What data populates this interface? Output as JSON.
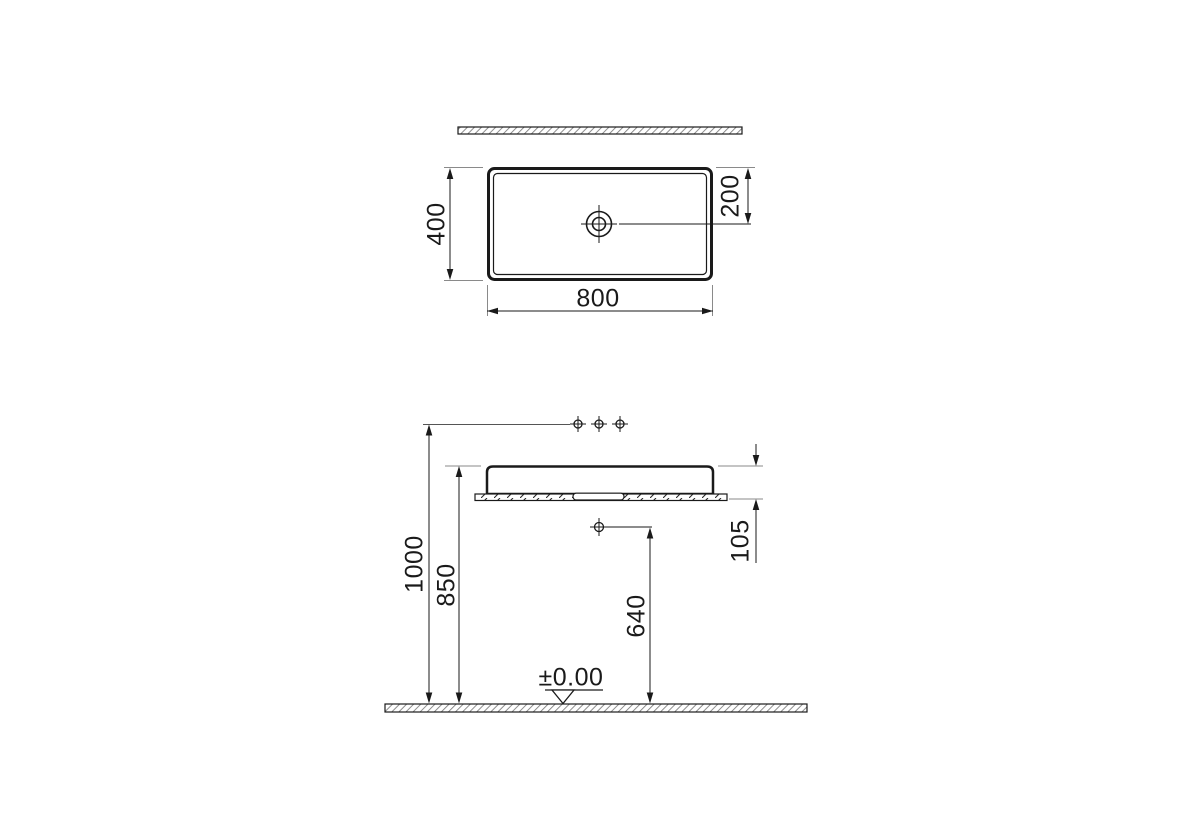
{
  "drawing": {
    "colors": {
      "line": "#1a1a1a",
      "extension_line": "#8a8a8a",
      "hatch": "#7a7a7a",
      "background": "#ffffff"
    },
    "top_view": {
      "labels": {
        "width": "800",
        "depth": "400",
        "drain_offset": "200"
      }
    },
    "front_view": {
      "labels": {
        "faucet_height": "1000",
        "rim_height": "850",
        "outlet_height": "640",
        "basin_height": "105",
        "floor_level": "±0.00"
      }
    },
    "icons": [
      "drain-icon",
      "faucet-holes-icon",
      "drain-outlet-icon",
      "level-marker-icon"
    ]
  }
}
